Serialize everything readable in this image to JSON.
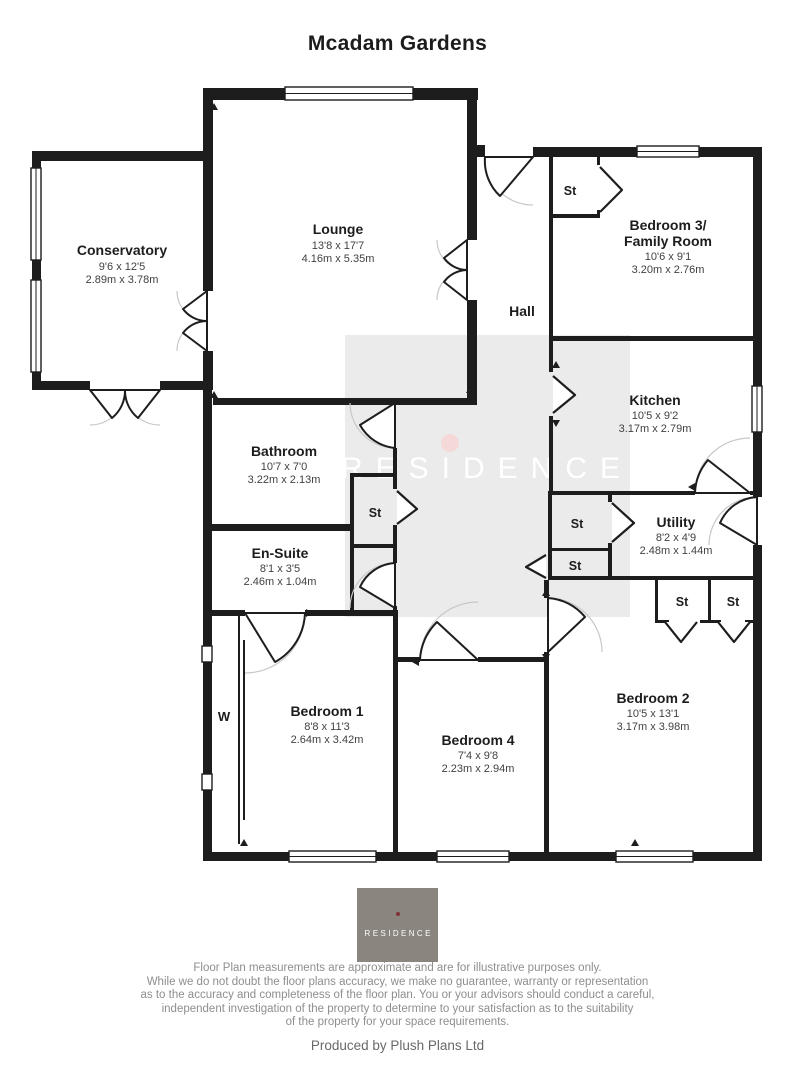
{
  "title": "Mcadam Gardens",
  "watermark": {
    "text": "RESIDENCE",
    "bg_color": "#ebebeb",
    "dot_color": "#f5d8d8"
  },
  "rooms": {
    "conservatory": {
      "name": "Conservatory",
      "dims_ft": "9'6 x 12'5",
      "dims_m": "2.89m x 3.78m"
    },
    "lounge": {
      "name": "Lounge",
      "dims_ft": "13'8 x 17'7",
      "dims_m": "4.16m x 5.35m"
    },
    "bedroom3": {
      "name_line1": "Bedroom 3/",
      "name_line2": "Family Room",
      "dims_ft": "10'6 x 9'1",
      "dims_m": "3.20m x 2.76m"
    },
    "hall": {
      "name": "Hall"
    },
    "kitchen": {
      "name": "Kitchen",
      "dims_ft": "10'5 x 9'2",
      "dims_m": "3.17m x 2.79m"
    },
    "bathroom": {
      "name": "Bathroom",
      "dims_ft": "10'7 x 7'0",
      "dims_m": "3.22m x 2.13m"
    },
    "ensuite": {
      "name": "En-Suite",
      "dims_ft": "8'1 x 3'5",
      "dims_m": "2.46m x 1.04m"
    },
    "utility": {
      "name": "Utility",
      "dims_ft": "8'2 x 4'9",
      "dims_m": "2.48m x 1.44m"
    },
    "bedroom1": {
      "name": "Bedroom 1",
      "dims_ft": "8'8 x 11'3",
      "dims_m": "2.64m x 3.42m"
    },
    "bedroom4": {
      "name": "Bedroom 4",
      "dims_ft": "7'4 x 9'8",
      "dims_m": "2.23m x 2.94m"
    },
    "bedroom2": {
      "name": "Bedroom 2",
      "dims_ft": "10'5 x 13'1",
      "dims_m": "3.17m x 3.98m"
    }
  },
  "labels": {
    "storage": "St",
    "wardrobe": "W"
  },
  "logo": {
    "text": "RESIDENCE"
  },
  "footer": {
    "disclaimer_lines": [
      "Floor Plan measurements are approximate and are for illustrative purposes only.",
      "While we do not doubt the floor plans accuracy, we make no guarantee, warranty or representation",
      "as to the accuracy and completeness of the floor plan. You or your advisors should conduct a careful,",
      "independent investigation of the property to determine to your satisfaction as to the suitability",
      "of the property for your space requirements."
    ],
    "produced_by": "Produced by Plush Plans Ltd"
  },
  "colors": {
    "wall": "#1d1d1d",
    "dims_text": "#414141",
    "footer_text": "#8e8e8e",
    "logo_bg": "#8a857e",
    "logo_dot": "#7d3535"
  }
}
